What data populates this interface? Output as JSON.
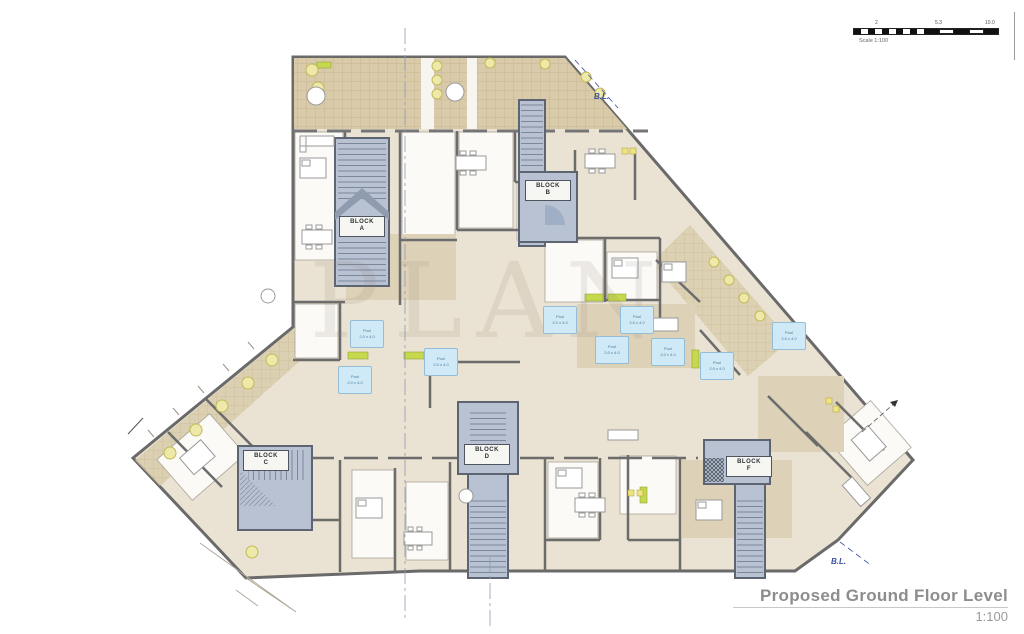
{
  "titleblock": {
    "title": "Proposed Ground Floor Level",
    "scale": "1:100"
  },
  "scale_bar": {
    "caption": "Scale 1:100",
    "tick_labels": [
      "2",
      "5.3",
      "10.0"
    ]
  },
  "watermark": "PLAN",
  "boundary": {
    "labels": [
      {
        "text": "B.L."
      },
      {
        "text": "B.L."
      }
    ]
  },
  "blocks": [
    {
      "name": "BLOCK",
      "letter": "A"
    },
    {
      "name": "BLOCK",
      "letter": "B"
    },
    {
      "name": "BLOCK",
      "letter": "C"
    },
    {
      "name": "BLOCK",
      "letter": "D"
    },
    {
      "name": "BLOCK",
      "letter": "F"
    }
  ],
  "pools": [
    {
      "line1": "Pool",
      "line2": "2.0 x 4.0"
    },
    {
      "line1": "Pool",
      "line2": "2.0 x 4.0"
    },
    {
      "line1": "Pool",
      "line2": "2.0 x 4.0"
    },
    {
      "line1": "Pool",
      "line2": "2.0 x 4.0"
    },
    {
      "line1": "Pool",
      "line2": "2.0 x 4.0"
    },
    {
      "line1": "Pool",
      "line2": "2.0 x 4.0"
    },
    {
      "line1": "Pool",
      "line2": "2.0 x 4.0"
    },
    {
      "line1": "Pool",
      "line2": "2.0 x 4.0"
    },
    {
      "line1": "Pool",
      "line2": "2.0 x 4.0"
    }
  ],
  "colors": {
    "interior_fill": "#eae2d2",
    "terrace_tile": "#d9cbaa",
    "stair_core": "#b8c2d3",
    "wall": "#6c6c6c",
    "pool_blue": "#cfe9f7",
    "planter_green": "#c6d94e",
    "boundary_blue": "#3b4f9f",
    "title_gray": "#8d8d8d"
  }
}
